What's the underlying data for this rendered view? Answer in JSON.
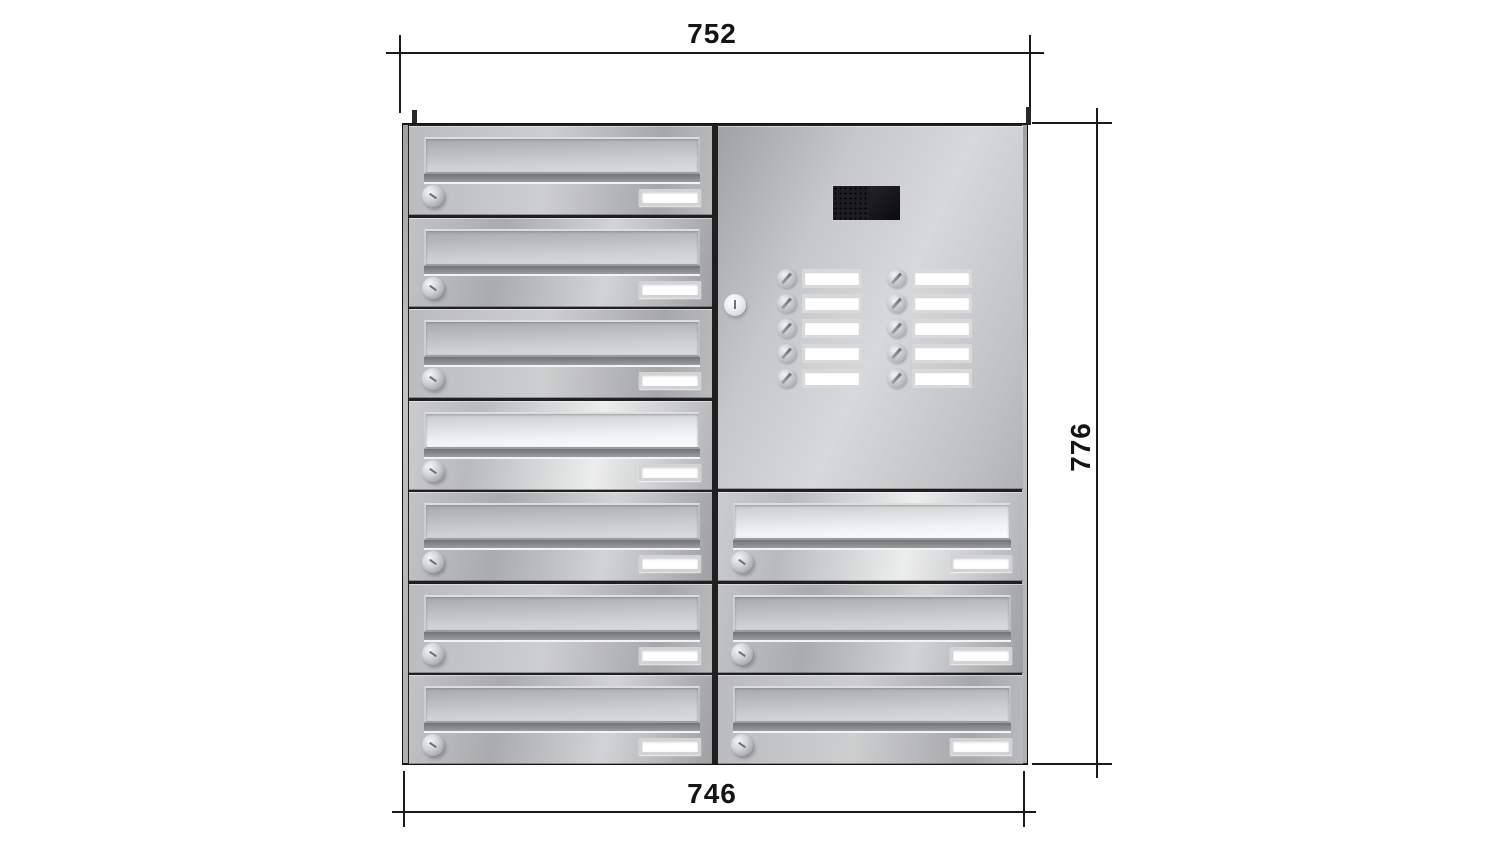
{
  "dimensions": {
    "top_width": "752",
    "right_height": "776",
    "bottom_width": "746"
  },
  "unit": {
    "columns": 2,
    "left_column": {
      "mailbox_count": 7
    },
    "right_column": {
      "mailbox_count": 3,
      "intercom_panel": {
        "black_module_parts": [
          "speaker-grille",
          "camera-window"
        ],
        "lock_count": 1,
        "bell_buttons": {
          "rows": 5,
          "columns": 2,
          "total": 10
        },
        "nameplate_count": 10,
        "nameplate_text": ""
      }
    },
    "mailbox_features": [
      "letter-flap",
      "lock-cylinder",
      "nameplate"
    ],
    "mailbox_nameplate_text": ""
  },
  "face_variants": {
    "left": [
      "v2",
      "v1",
      "v2",
      "bright",
      "v1",
      "v2",
      "v1"
    ],
    "right": [
      "bright",
      "v1",
      "v2"
    ]
  },
  "colors": {
    "background": "#ffffff",
    "dimension_lines": "#1a1a1a",
    "steel_light": "#e8e9eb",
    "steel_mid": "#b5b6b8",
    "steel_dark": "#8e8f92",
    "frame_dark": "#202021",
    "module_black": "#141416",
    "nameplate": "#ffffff"
  }
}
